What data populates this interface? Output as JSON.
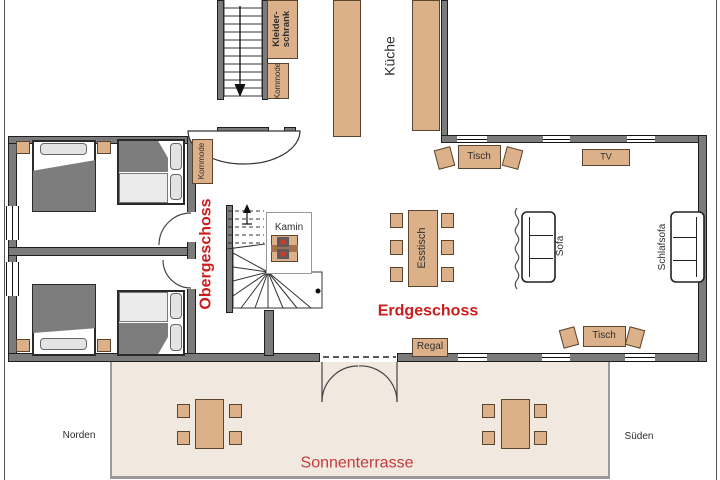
{
  "palette": {
    "wall": "#7b7b7b",
    "furniture": "#dcb18a",
    "terrace": "#f1e8df",
    "floor_label_red": "#cc1c1c",
    "terrace_label_red": "#c23b3b",
    "bed_blanket_gray": "#7d7d7d",
    "text_dark": "#2e2e2e"
  },
  "floor_labels": {
    "upper": "Obergeschoss",
    "ground": "Erdgeschoss"
  },
  "areas": {
    "kitchen": "Küche",
    "terrace": "Sonnenterrasse"
  },
  "compass": {
    "north": "Norden",
    "south": "Süden"
  },
  "furniture": {
    "wardrobe": "Kleider-\nschrank",
    "dresser_hall": "Kommode",
    "dresser_bedroom": "Kommode",
    "fireplace": "Kamin",
    "dining_table": "Esstisch",
    "sofa": "Sofa",
    "sleeper_sofa": "Schlafsofa",
    "tv": "TV",
    "table_top": "Tisch",
    "table_bottom": "Tisch",
    "shelf": "Regal"
  }
}
